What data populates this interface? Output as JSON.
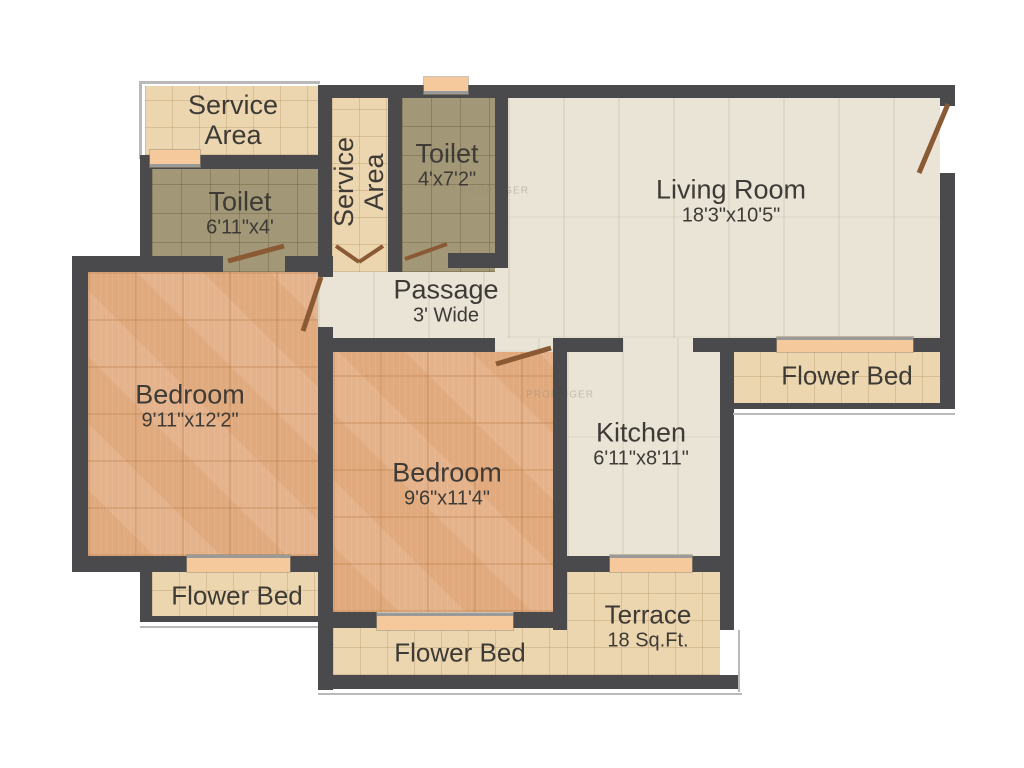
{
  "watermark": "PROPTIGER",
  "colors": {
    "wall": "#4a4a4c",
    "floor_cream": "#e9e4d6",
    "floor_wood": "#e3ad81",
    "tile_beige": "#ecd6b0",
    "tile_olive": "#a29776",
    "window_sill": "#f6c99d",
    "door_leaf": "#8a5a35",
    "label_text": "#3e3a35"
  },
  "rooms": {
    "service_area_top": {
      "name": "Service Area",
      "dims": ""
    },
    "toilet_left": {
      "name": "Toilet",
      "dims": "6'11\"x4'"
    },
    "service_area_mid": {
      "name": "Service Area",
      "dims": ""
    },
    "toilet_top": {
      "name": "Toilet",
      "dims": "4'x7'2\""
    },
    "living_room": {
      "name": "Living Room",
      "dims": "18'3\"x10'5\""
    },
    "passage": {
      "name": "Passage",
      "dims": "3' Wide"
    },
    "bedroom_left": {
      "name": "Bedroom",
      "dims": "9'11\"x12'2\""
    },
    "bedroom_mid": {
      "name": "Bedroom",
      "dims": "9'6\"x11'4\""
    },
    "kitchen": {
      "name": "Kitchen",
      "dims": "6'11\"x8'11\""
    },
    "flower_bed_right": {
      "name": "Flower Bed",
      "dims": ""
    },
    "flower_bed_left": {
      "name": "Flower Bed",
      "dims": ""
    },
    "flower_bed_bottom": {
      "name": "Flower Bed",
      "dims": ""
    },
    "terrace": {
      "name": "Terrace",
      "dims": "18 Sq.Ft."
    }
  }
}
